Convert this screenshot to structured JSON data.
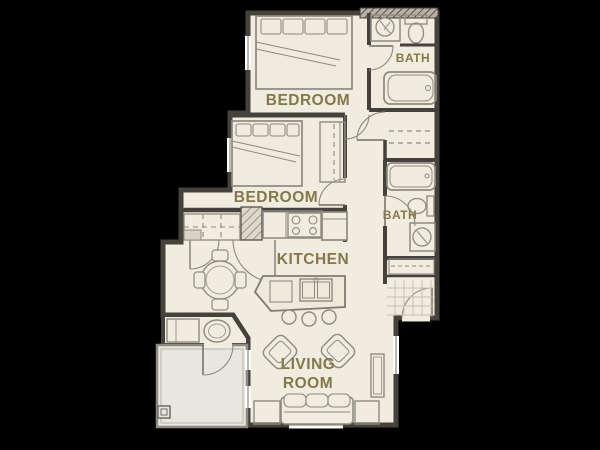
{
  "plan_title": "Two bedroom / two bath apartment floor plan",
  "colors": {
    "background": "#000000",
    "floor": "#f1ece0",
    "patio_floor": "#e9e6df",
    "wall": "#45423c",
    "fixture_line": "#8d8a81",
    "tile_line": "#c5c0b2",
    "label_text": "#857747"
  },
  "rooms": {
    "bedroom1": {
      "label": "BEDROOM"
    },
    "bedroom2": {
      "label": "BEDROOM"
    },
    "bath1": {
      "label": "BATH"
    },
    "bath2": {
      "label": "BATH"
    },
    "kitchen": {
      "label": "KITCHEN"
    },
    "living": {
      "label_line1": "LIVING",
      "label_line2": "ROOM"
    }
  },
  "fixtures": {
    "bedroom1": [
      "queen-bed",
      "window"
    ],
    "bedroom2": [
      "queen-bed",
      "reach-in-closet",
      "window"
    ],
    "bath1": [
      "vanity-sink",
      "toilet",
      "bathtub"
    ],
    "bath2": [
      "bathtub",
      "toilet",
      "vanity-sink"
    ],
    "hall": [
      "linen-closet"
    ],
    "kitchen": [
      "range-cooktop",
      "refrigerator",
      "island-with-sink",
      "bar-stools",
      "upper-cabinets"
    ],
    "dining": [
      "round-table",
      "four-chairs",
      "double-door-closet"
    ],
    "living": [
      "sofa",
      "two-armchairs",
      "end-tables",
      "media-console",
      "windows"
    ],
    "entry": [
      "entry-door",
      "shelf-closet",
      "tile-floor"
    ],
    "utility": [
      "counter",
      "laundry-tub",
      "patio-door"
    ],
    "outdoor": [
      "patio",
      "corner-post"
    ]
  }
}
